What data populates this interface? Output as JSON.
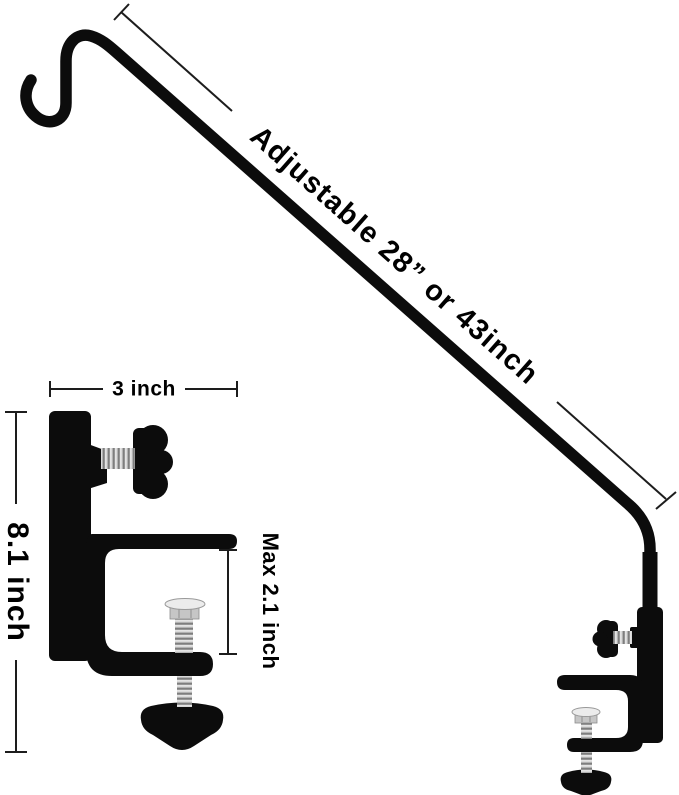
{
  "annotations": {
    "pole_length": "Adjustable 28” or 43inch",
    "clamp_width": "3 inch",
    "overall_height": "8.1 inch",
    "clamp_max_opening": "Max 2.1 inch"
  },
  "colors": {
    "background": "#ffffff",
    "product": "#0c0c0c",
    "dimension_lines": "#1d1d1d",
    "annotation_text": "#000000",
    "screw_metal": "#b2b2b2"
  }
}
